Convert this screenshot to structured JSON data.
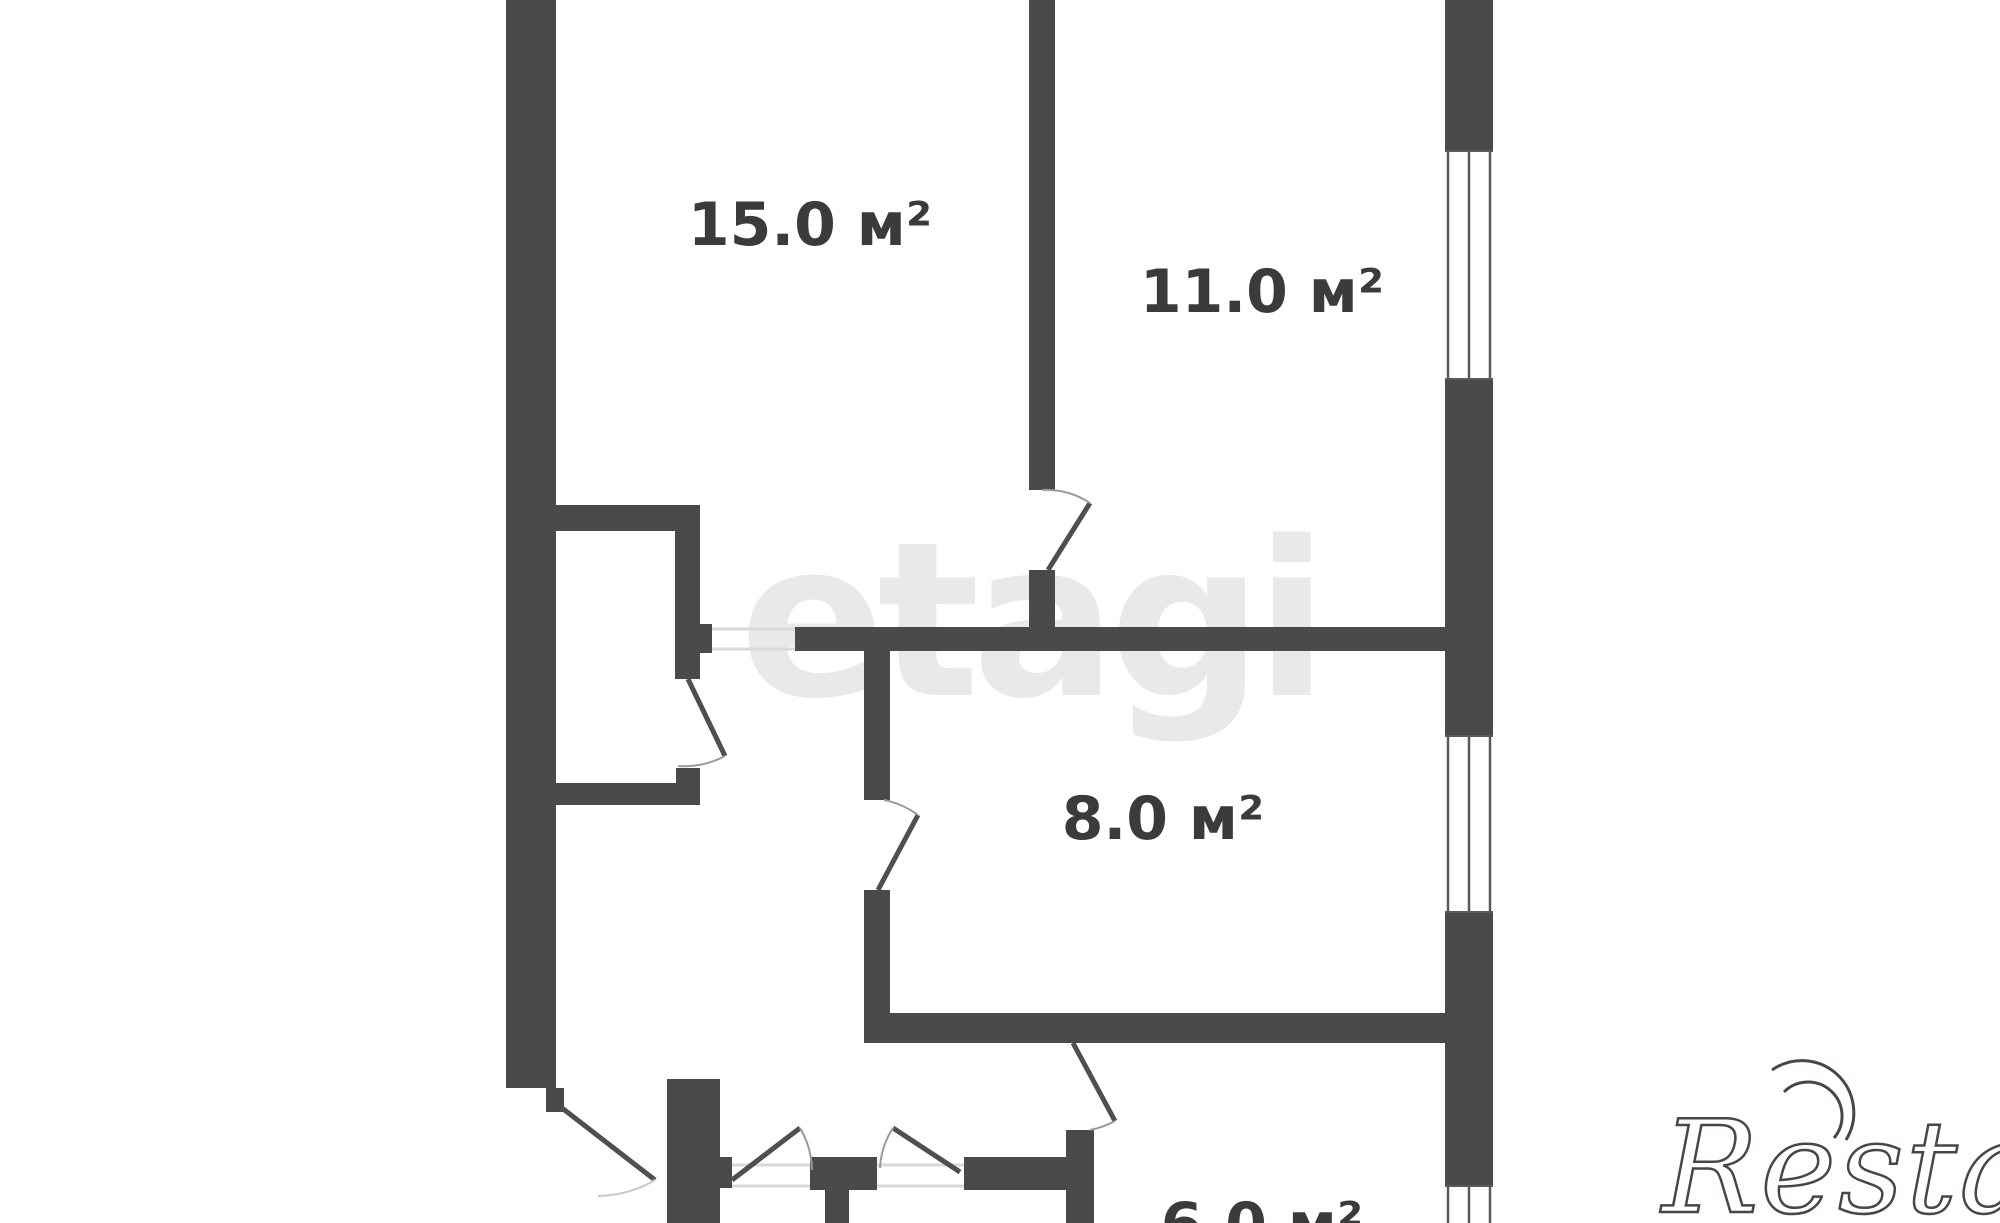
{
  "page": {
    "background": "#ffffff",
    "kind": "apartment floor plan"
  },
  "colors": {
    "page_bg": "#ffffff",
    "wall": "#4a4a4a",
    "label": "#3b3b3b",
    "door_line": "#4f4f4f",
    "arc_line": "#9a9a9a",
    "threshold": "#d9d9d9",
    "window_line": "#5a5a5a",
    "watermark_etagi": "#e9e9e9",
    "watermark_restate": "#4a4645"
  },
  "floorplan": {
    "rooms": [
      {
        "id": "room-15",
        "area_label": "15.0 м²"
      },
      {
        "id": "room-11",
        "area_label": "11.0 м²"
      },
      {
        "id": "room-8",
        "area_label": "8.0 м²"
      },
      {
        "id": "room-6",
        "area_label": "6.0 м²"
      }
    ]
  },
  "watermarks": {
    "center_logo": "etagi",
    "corner_logo": "Restate"
  }
}
